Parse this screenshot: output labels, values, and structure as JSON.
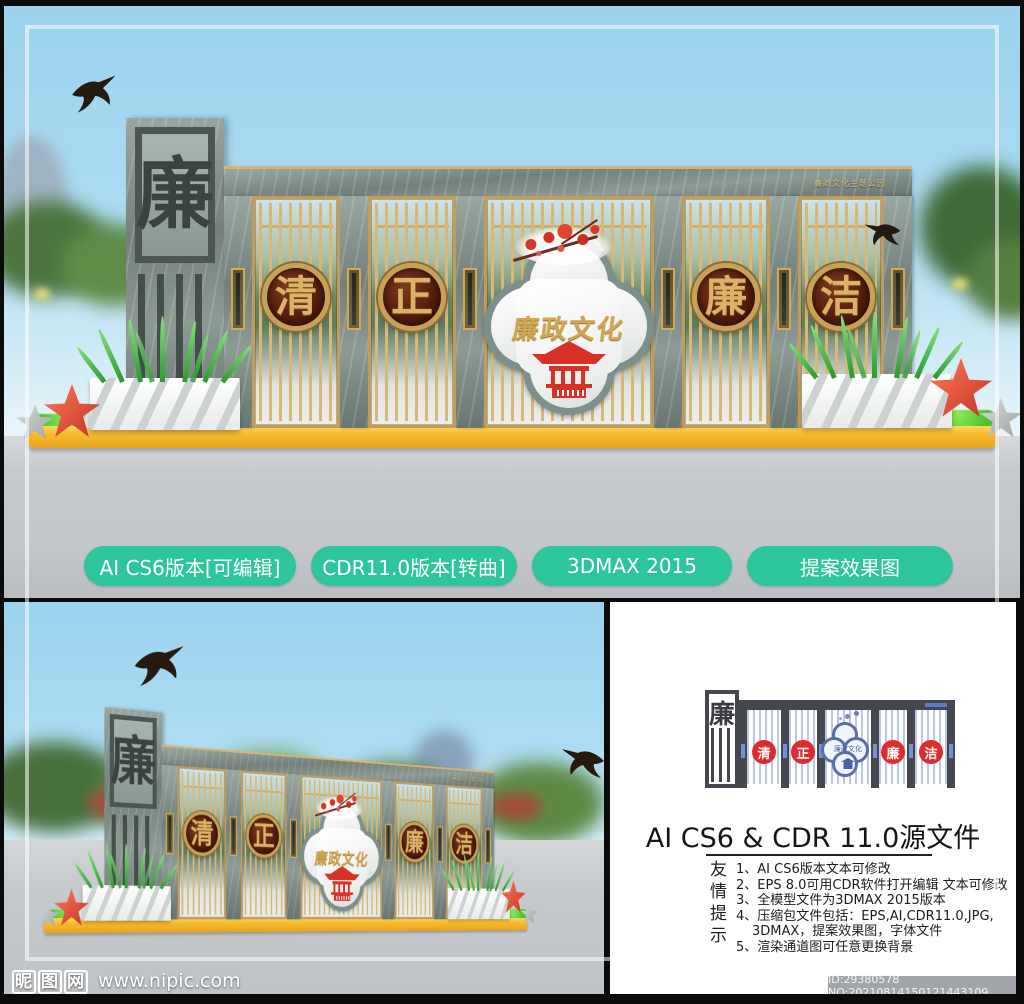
{
  "top_render": {
    "park_label": "廉政文化主题公园",
    "tower_char": "廉",
    "medallions": [
      "清",
      "正",
      "廉",
      "洁"
    ],
    "center_title": "廉政文化"
  },
  "buttons": [
    "AI CS6版本[可编辑]",
    "CDR11.0版本[转曲]",
    "3DMAX 2015",
    "提案效果图"
  ],
  "panel": {
    "title": "AI CS6 & CDR 11.0源文件",
    "tips_label": "友情提示",
    "tips": [
      "1、AI CS6版本文本可修改",
      "2、EPS 8.0可用CDR软件打开编辑 文本可修改",
      "3、全模型文件为3DMAX 2015版本",
      "4、压缩包文件包括：EPS,AI,CDR11.0,JPG,",
      "3DMAX，提案效果图，字体文件",
      "5、渲染通道图可任意更换背景"
    ],
    "diagram": {
      "tower_char": "廉",
      "medallions": [
        "清",
        "正",
        "廉",
        "洁"
      ],
      "center_title": "廉政文化"
    }
  },
  "footer": {
    "site": "昵图网",
    "url": "www.nipic.com",
    "id_text": "ID:29380578 NO:20210814150121443109"
  },
  "colors": {
    "button_green": "#2dc59b",
    "gold": "#d2a958",
    "medallion_maroon": "#5a2012",
    "accent_red": "#d83226",
    "stone_gray": "#85928c",
    "base_yellow": "#f2b42d",
    "sky_blue": "#a8d7ee",
    "diagram_stripe_blue": "#b9c8e8",
    "diagram_dark": "#46464e",
    "diagram_red": "#df2b2b"
  }
}
